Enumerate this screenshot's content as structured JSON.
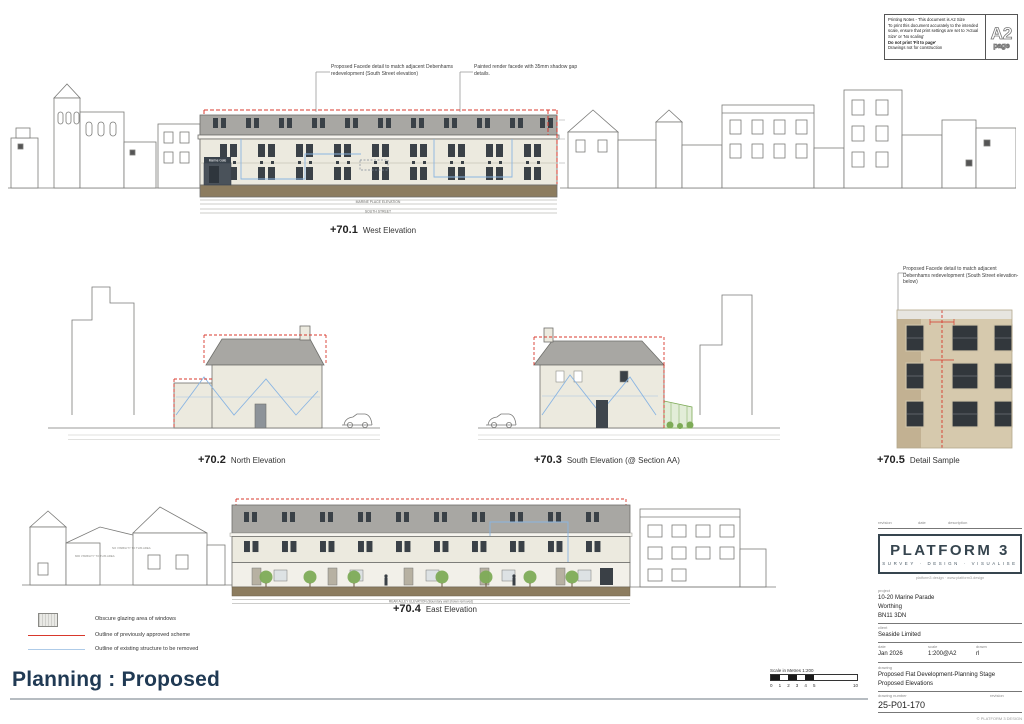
{
  "colors": {
    "accent_red": "#d8382c",
    "accent_blue": "#8ab5e2",
    "facade_cream": "#eceadf",
    "roof_grey": "#a8a7a3",
    "ground_brown": "#8c7c5f",
    "title_navy": "#203a54",
    "tree_green": "#7dab57"
  },
  "printing_notes": {
    "line1": "Printing Notes - This document is A2 Size",
    "line2": "To print this document accurately to the intended scale, ensure that print settings are set to 'Actual Size' or 'No scaling'",
    "line3": "Do not print 'Fit to page'",
    "line4": "Drawings not for construction",
    "page_size": "A2",
    "page_word": "page"
  },
  "annotations": {
    "west_facade_detail": "Proposed Facede detail to match adjacent Debenhams redevelopment (South Street elevation)",
    "west_render": "Painted render facede with 35mm shadow gap details.",
    "detail_sample": "Proposed Facede detail to match adjacent Debenhams redevelopment (South Street elevation- below)"
  },
  "elevations": [
    {
      "number": "+70.1",
      "label": "West Elevation"
    },
    {
      "number": "+70.2",
      "label": "North Elevation"
    },
    {
      "number": "+70.3",
      "label": "South Elevation  (@ Section AA)"
    },
    {
      "number": "+70.4",
      "label": "East Elevation"
    },
    {
      "number": "+70.5",
      "label": "Detail Sample"
    }
  ],
  "drawing_captions": {
    "marine_gate_sign": "Marine Gate",
    "west_caption_1": "MARINE PLACE ELEVATION",
    "west_caption_2": "SOUTH STREET",
    "east_caption": "REAR ALLEY ELEVATION (Boundary wall shown removed)",
    "mid_visibility": "MID VISIBILITY TO THIS AREA",
    "no_visibility": "NO VISIBILITY TO THIS AREA"
  },
  "legend": [
    {
      "label": "Obscure glazing area of windows"
    },
    {
      "label": "Outline of previously approved scheme"
    },
    {
      "label": "Outline of existing structure to be removed"
    }
  ],
  "footer": {
    "title": "Planning : Proposed",
    "scale_label": "Scale in Metres 1:200",
    "scale_ticks": [
      "0",
      "1",
      "2",
      "3",
      "4",
      "5",
      "10"
    ]
  },
  "title_block": {
    "rev_header": {
      "revision": "revision",
      "date": "date",
      "description": "description"
    },
    "logo_name": "PLATFORM 3",
    "logo_tagline": "SURVEY · DESIGN · VISUALISE",
    "logo_contact": "platform3 design · www.platform3.design",
    "labels": {
      "project": "project",
      "client": "client",
      "date": "date",
      "scale": "scale",
      "drawn": "drawn",
      "drawing": "drawing",
      "number": "drawing number",
      "revision": "revision"
    },
    "project": [
      "10-20 Marine Parade",
      "Worthing",
      "BN11 3DN"
    ],
    "client": "Seaside Limited",
    "date": "Jan 2026",
    "scale": "1:200@A2",
    "drawn": "rl",
    "drawing_line1": "Proposed Flat Development-Planning Stage",
    "drawing_line2": "Proposed Elevations",
    "number": "25-P01-170",
    "copyright": "© PLATFORM 3 DESIGN"
  }
}
